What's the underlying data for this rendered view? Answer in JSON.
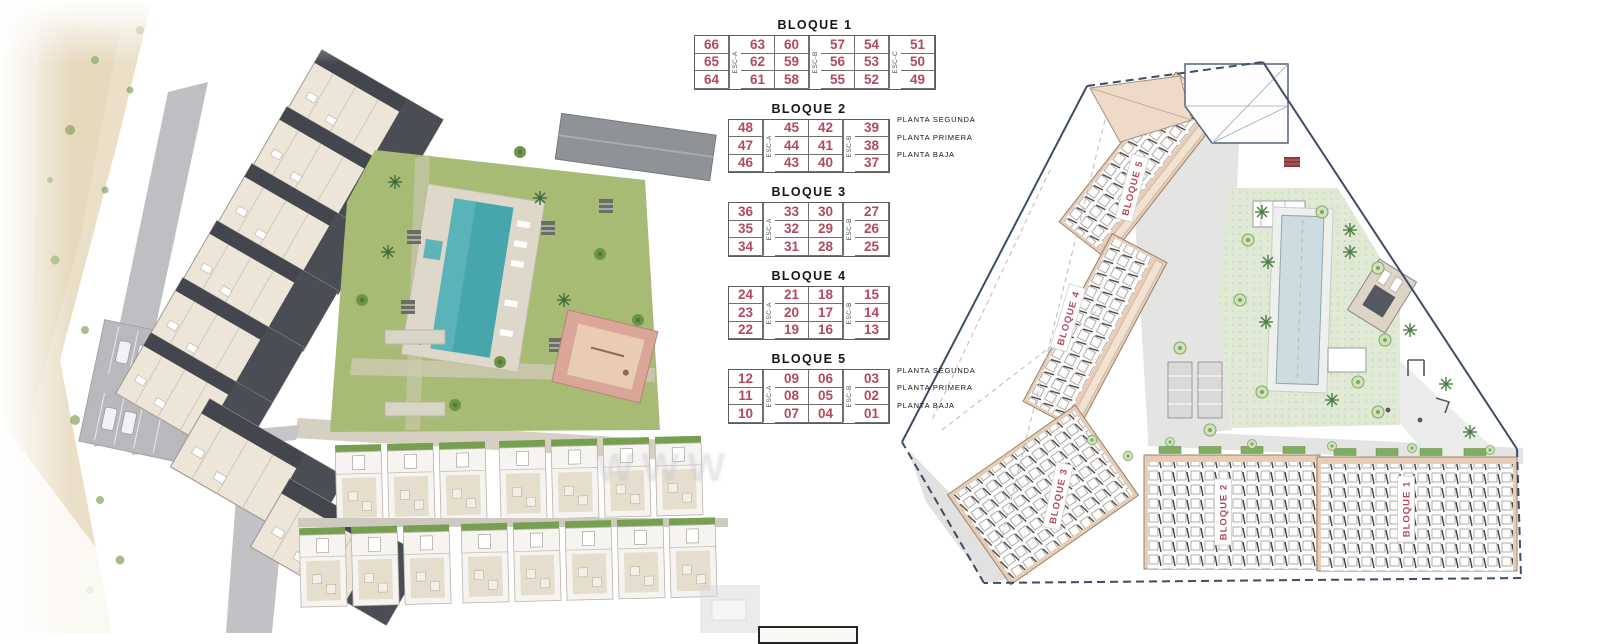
{
  "colors": {
    "unit_number_red": "#b5485e",
    "plan_label_red": "#b5485e",
    "table_border": "#5c5c5c",
    "boundary_navy": "#3c4d66",
    "building_tan": "#e8cdb4",
    "lawn_green": "#dfe9d3",
    "plan_pool_blue": "#cddce1",
    "render_pool_teal": "#47a6ac",
    "render_grass_green": "#a8bb74",
    "sand_beige": "#ebdfc8",
    "road_gray": "#bfbfc3",
    "roof_dark_gray": "#43474d"
  },
  "middle_tables": {
    "blocks": [
      {
        "title": "BLOQUE 1",
        "esc": [
          "ESC-A",
          "ESC-B",
          "ESC-C"
        ],
        "groups": [
          1,
          2,
          2,
          1
        ],
        "rows": [
          [
            "66",
            "63",
            "60",
            "57",
            "54",
            "51"
          ],
          [
            "65",
            "62",
            "59",
            "56",
            "53",
            "50"
          ],
          [
            "64",
            "61",
            "58",
            "55",
            "52",
            "49"
          ]
        ],
        "row_labels": []
      },
      {
        "title": "BLOQUE 2",
        "esc": [
          "ESC-A",
          "ESC-B"
        ],
        "groups": [
          1,
          2,
          1
        ],
        "rows": [
          [
            "48",
            "45",
            "42",
            "39"
          ],
          [
            "47",
            "44",
            "41",
            "38"
          ],
          [
            "46",
            "43",
            "40",
            "37"
          ]
        ],
        "row_labels": [
          "PLANTA SEGUNDA",
          "PLANTA PRIMERA",
          "PLANTA BAJA"
        ]
      },
      {
        "title": "BLOQUE 3",
        "esc": [
          "ESC-A",
          "ESC-B"
        ],
        "groups": [
          1,
          2,
          1
        ],
        "rows": [
          [
            "36",
            "33",
            "30",
            "27"
          ],
          [
            "35",
            "32",
            "29",
            "26"
          ],
          [
            "34",
            "31",
            "28",
            "25"
          ]
        ],
        "row_labels": []
      },
      {
        "title": "BLOQUE 4",
        "esc": [
          "ESC-A",
          "ESC-B"
        ],
        "groups": [
          1,
          2,
          1
        ],
        "rows": [
          [
            "24",
            "21",
            "18",
            "15"
          ],
          [
            "23",
            "20",
            "17",
            "14"
          ],
          [
            "22",
            "19",
            "16",
            "13"
          ]
        ],
        "row_labels": []
      },
      {
        "title": "BLOQUE 5",
        "esc": [
          "ESC-A",
          "ESC-B"
        ],
        "groups": [
          1,
          2,
          1
        ],
        "rows": [
          [
            "12",
            "09",
            "06",
            "03"
          ],
          [
            "11",
            "08",
            "05",
            "02"
          ],
          [
            "10",
            "07",
            "04",
            "01"
          ]
        ],
        "row_labels": [
          "PLANTA SEGUNDA",
          "PLANTA PRIMERA",
          "PLANTA BAJA"
        ]
      }
    ]
  },
  "site_plan": {
    "labels": [
      {
        "text": "BLOQUE 5"
      },
      {
        "text": "BLOQUE 4"
      },
      {
        "text": "BLOQUE 3"
      },
      {
        "text": "BLOQUE 2"
      },
      {
        "text": "BLOQUE 1"
      }
    ]
  },
  "watermark": "WWW"
}
